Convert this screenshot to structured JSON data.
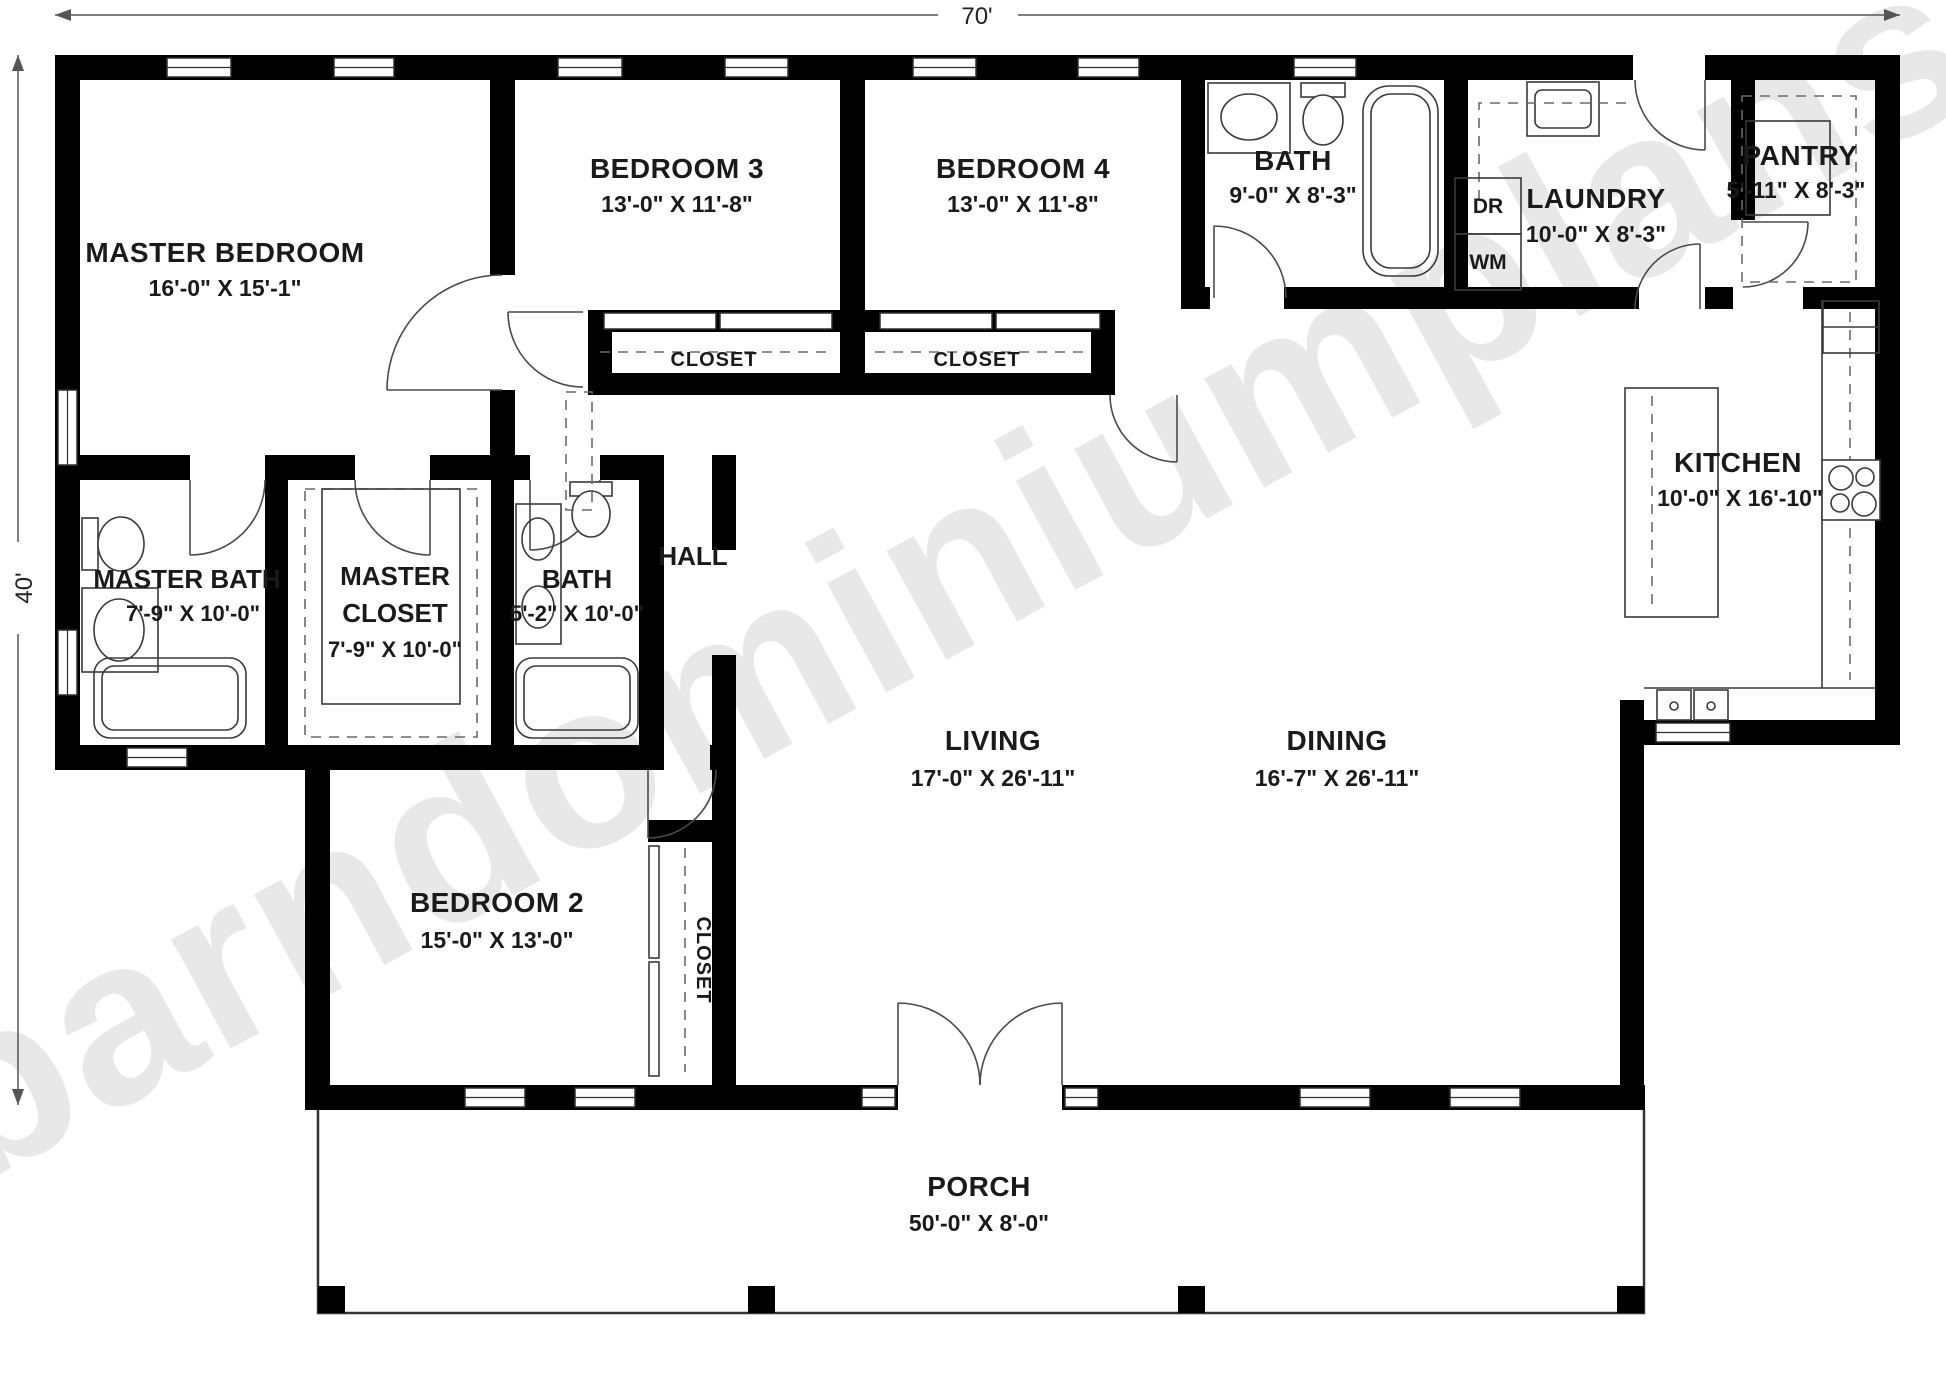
{
  "plan": {
    "watermark": "barndominiumplans.com",
    "overall_width": "70'",
    "overall_depth": "40'",
    "closet_label": "CLOSET",
    "appliances": {
      "dryer": "DR",
      "washer": "WM"
    },
    "rooms": [
      {
        "id": "master-bedroom",
        "name": "MASTER BEDROOM",
        "dims": "16'-0\" X 15'-1\""
      },
      {
        "id": "bedroom-3",
        "name": "BEDROOM 3",
        "dims": "13'-0\" X 11'-8\""
      },
      {
        "id": "bedroom-4",
        "name": "BEDROOM 4",
        "dims": "13'-0\" X 11'-8\""
      },
      {
        "id": "bath",
        "name": "BATH",
        "dims": "9'-0\" X 8'-3\""
      },
      {
        "id": "laundry",
        "name": "LAUNDRY",
        "dims": "10'-0\" X 8'-3\""
      },
      {
        "id": "pantry",
        "name": "PANTRY",
        "dims": "5'-11\" X 8'-3\""
      },
      {
        "id": "master-bath",
        "name": "MASTER BATH",
        "dims": "7'-9\" X 10'-0\""
      },
      {
        "id": "master-closet",
        "name": "MASTER CLOSET",
        "name_line1": "MASTER",
        "name_line2": "CLOSET",
        "dims": "7'-9\" X 10'-0\""
      },
      {
        "id": "bath-2",
        "name": "BATH",
        "dims": "5'-2\" X 10'-0\""
      },
      {
        "id": "hall",
        "name": "HALL",
        "dims": ""
      },
      {
        "id": "kitchen",
        "name": "KITCHEN",
        "dims": "10'-0\" X 16'-10\""
      },
      {
        "id": "living",
        "name": "LIVING",
        "dims": "17'-0\" X 26'-11\""
      },
      {
        "id": "dining",
        "name": "DINING",
        "dims": "16'-7\" X 26'-11\""
      },
      {
        "id": "bedroom-2",
        "name": "BEDROOM 2",
        "dims": "15'-0\" X 13'-0\""
      },
      {
        "id": "porch",
        "name": "PORCH",
        "dims": "50'-0\" X 8'-0\""
      }
    ]
  }
}
